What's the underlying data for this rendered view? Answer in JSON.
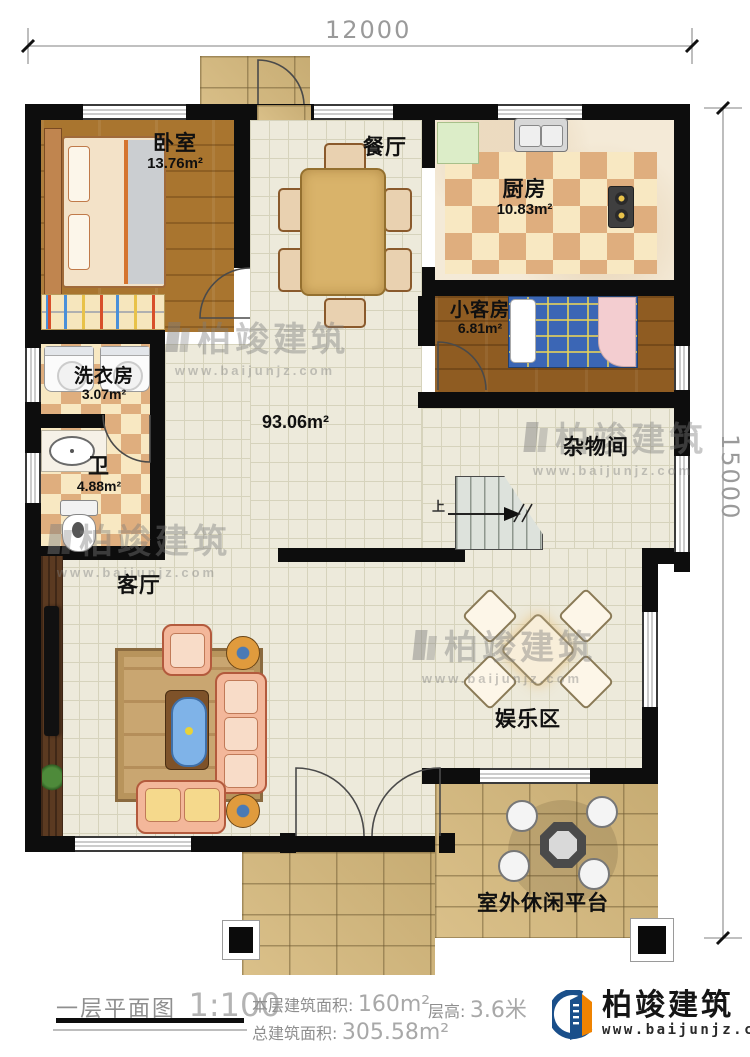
{
  "dimensions": {
    "top": "12000",
    "right": "15000"
  },
  "rooms": [
    {
      "label": "卧室",
      "area": "13.76m²"
    },
    {
      "label": "餐厅",
      "area": ""
    },
    {
      "label": "厨房",
      "area": "10.83m²"
    },
    {
      "label": "小客房",
      "area": "6.81m²"
    },
    {
      "label": "洗衣房",
      "area": "3.07m²"
    },
    {
      "label": "卫",
      "area": "4.88m²"
    },
    {
      "label": "",
      "area": "93.06m²"
    },
    {
      "label": "杂物间",
      "area": ""
    },
    {
      "label": "客厅",
      "area": ""
    },
    {
      "label": "娱乐区",
      "area": ""
    },
    {
      "label": "室外休闲平台",
      "area": ""
    }
  ],
  "stairs": {
    "up_label": "上"
  },
  "watermark": {
    "name": "柏竣建筑",
    "url": "www.baijunjz.com"
  },
  "footer": {
    "plan_name": "一层平面图",
    "scale": "1:100",
    "floor_area_label": "本层建筑面积:",
    "floor_area_value": "160m²",
    "storey_height_label": "层高:",
    "storey_height_value": "3.6米",
    "total_area_label": "总建筑面积:",
    "total_area_value": "305.58m²"
  },
  "brand": {
    "name": "柏竣建筑",
    "url": "www.baijunjz.com"
  },
  "colors": {
    "wall": "#0d0d0d",
    "brand_orange": "#f08300",
    "brand_blue": "#1a4f8a"
  }
}
